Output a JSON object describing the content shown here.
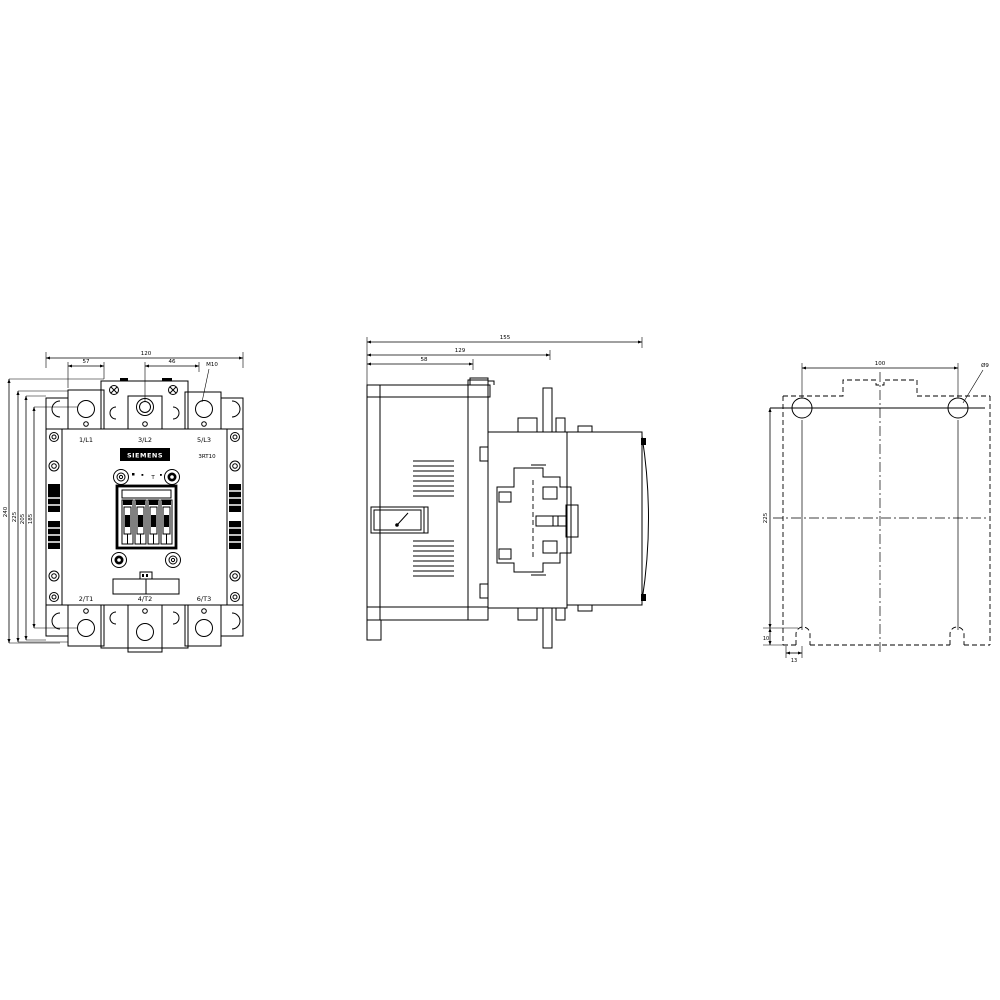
{
  "front": {
    "terminals_top": [
      "1/L1",
      "3/L2",
      "5/L3"
    ],
    "terminals_bottom": [
      "2/T1",
      "4/T2",
      "6/T3"
    ],
    "brand": "SIEMENS",
    "model": "3RT10",
    "coil_mark": "T",
    "dims": {
      "overall_width": "120",
      "lug_width": "57",
      "lug_spacing": "46",
      "terminal_screw": "M10",
      "heights": [
        "240",
        "225",
        "205",
        "185"
      ]
    }
  },
  "side": {
    "dims": {
      "overall_depth": "155",
      "depth_to_mount": "129",
      "arc_chute_depth": "58"
    }
  },
  "rear": {
    "dims": {
      "hole_spacing_h": "100",
      "hole_dia": "Ø9",
      "hole_spacing_v": "225",
      "notch_offset_v": "10",
      "notch_offset_h": "13"
    }
  },
  "colors": {
    "line": "#000000",
    "background": "#ffffff"
  }
}
